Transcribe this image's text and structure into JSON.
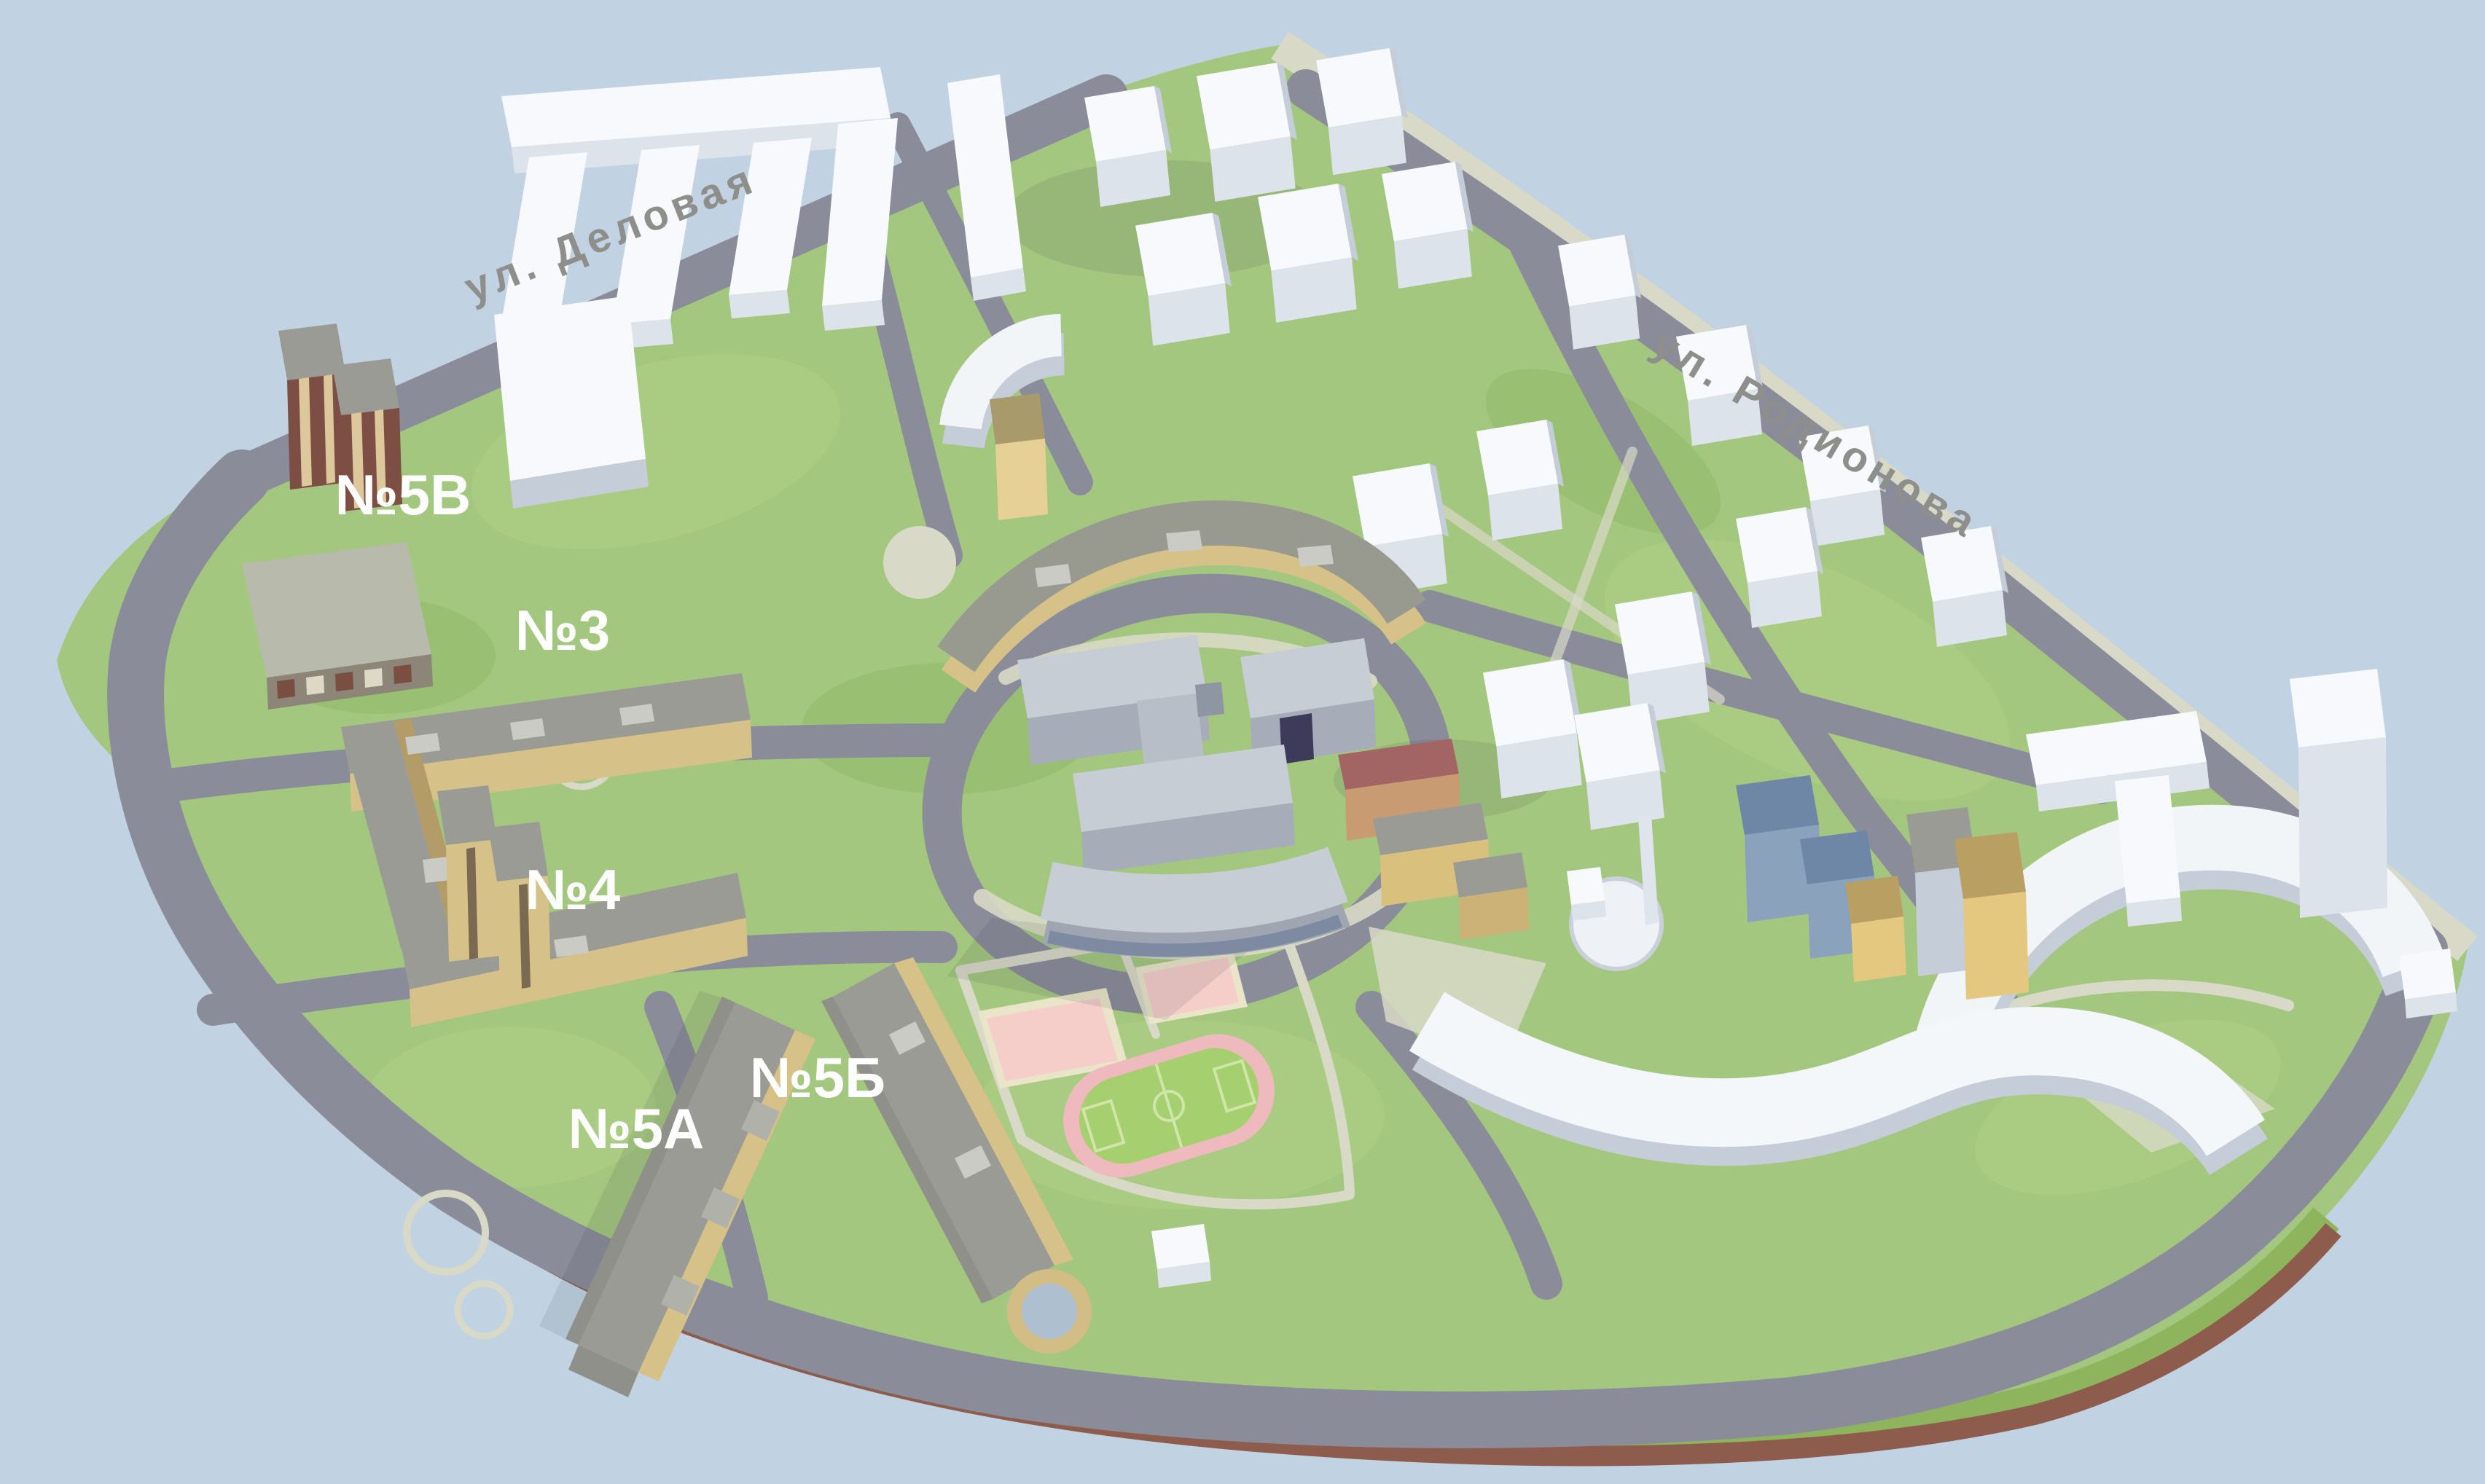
{
  "scene": {
    "description": "3D site plan of a residential district",
    "background_color": "#c1d3e2",
    "streets": [
      {
        "id": "delovaya",
        "name": "ул. Деловая",
        "transform": "rotate(-21.5 845 338)"
      },
      {
        "id": "rodionova",
        "name": "ул. Родионова",
        "transform": "rotate(30.5 2482 612)"
      }
    ],
    "buildings": [
      {
        "id": "5v",
        "label": "№5В"
      },
      {
        "id": "3",
        "label": "№3"
      },
      {
        "id": "4",
        "label": "№4"
      },
      {
        "id": "5a",
        "label": "№5А"
      },
      {
        "id": "5b",
        "label": "№5Б"
      }
    ],
    "palette": {
      "water": "#c1d3e2",
      "grass": "#a3c77e",
      "road": "#8b8c9a",
      "footpath": "#d8d9c7",
      "white_building_top": "#f7f9fc",
      "white_building_side": "#dde3ea",
      "beige_facade": "#d6c189",
      "gray_roof": "#9a9b94",
      "brown_tower": "#7d4f44",
      "school_wall": "#a6adb9",
      "blue_building": "#8ba2bd",
      "court_pink": "#f5cdc9",
      "field_green": "#a6d06f",
      "track_pink": "#efbabd",
      "embankment_brown": "#8d5c4c",
      "building_label": "#ffffff",
      "street_label": "#8e8e8a"
    }
  }
}
